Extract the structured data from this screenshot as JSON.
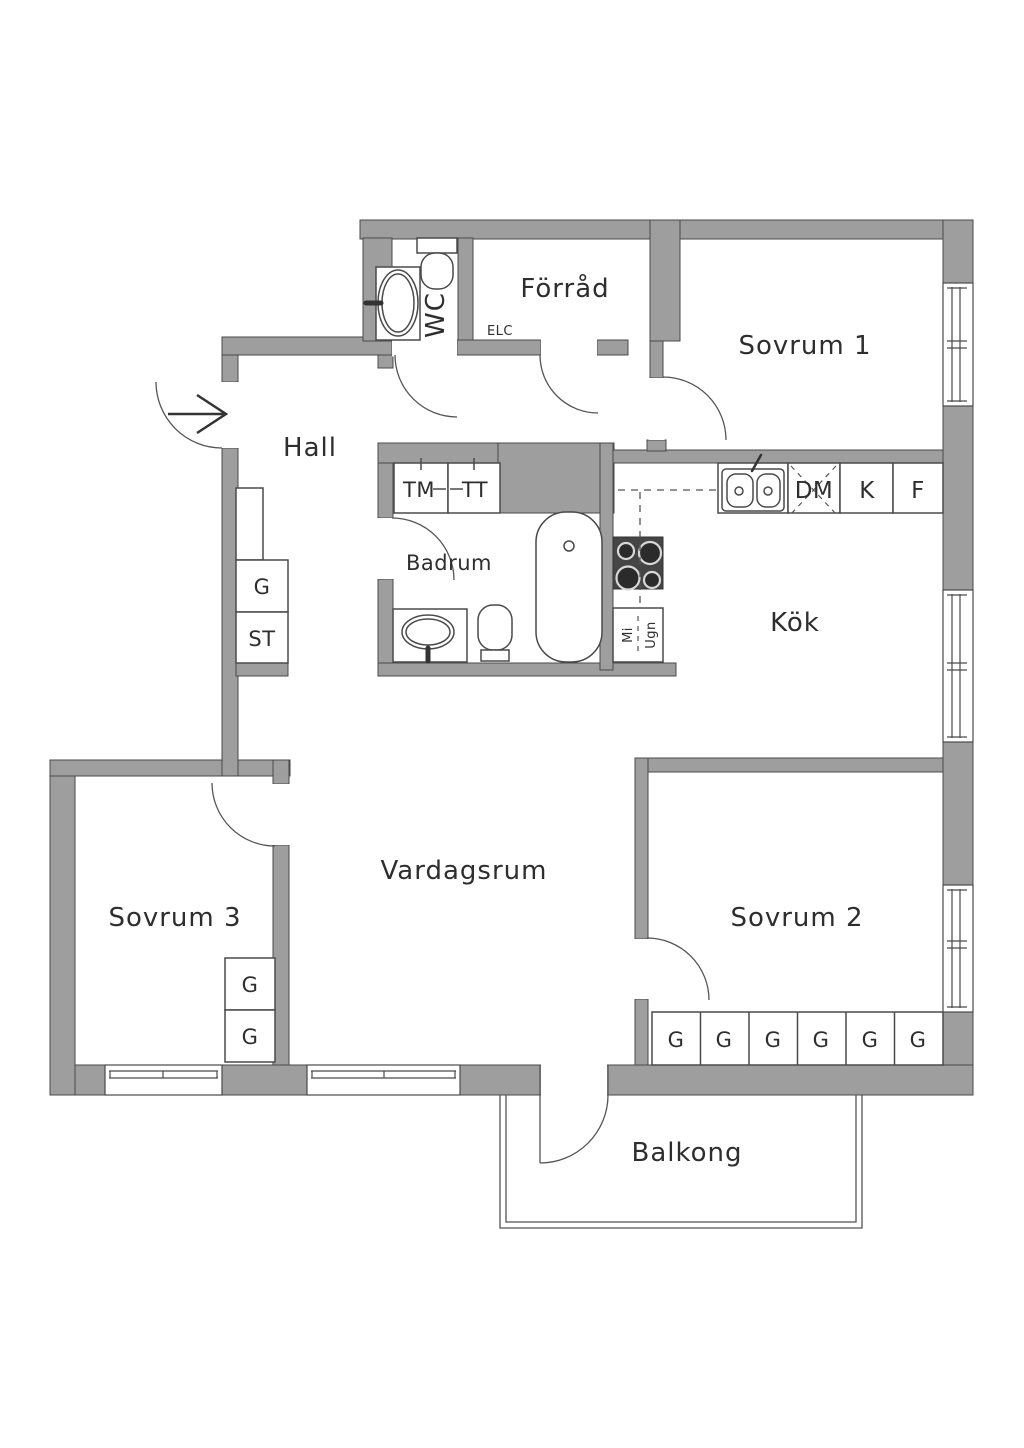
{
  "colors": {
    "background": "#ffffff",
    "wall": "#9e9e9e",
    "line": "#4a4a4a",
    "text": "#2e2e2e",
    "stove": "#454545"
  },
  "rooms": {
    "hall": "Hall",
    "wc": "WC",
    "forrad": "Förråd",
    "elc": "ELC",
    "sovrum1": "Sovrum 1",
    "badrum": "Badrum",
    "kok": "Kök",
    "vardagsrum": "Vardagsrum",
    "sovrum2": "Sovrum 2",
    "sovrum3": "Sovrum 3",
    "balkong": "Balkong"
  },
  "appliances": {
    "tm": "TM",
    "tt": "TT",
    "dm": "DM",
    "k": "K",
    "f": "F",
    "mi": "Mi",
    "ugn": "Ugn"
  },
  "storage": {
    "g": "G",
    "st": "ST"
  }
}
